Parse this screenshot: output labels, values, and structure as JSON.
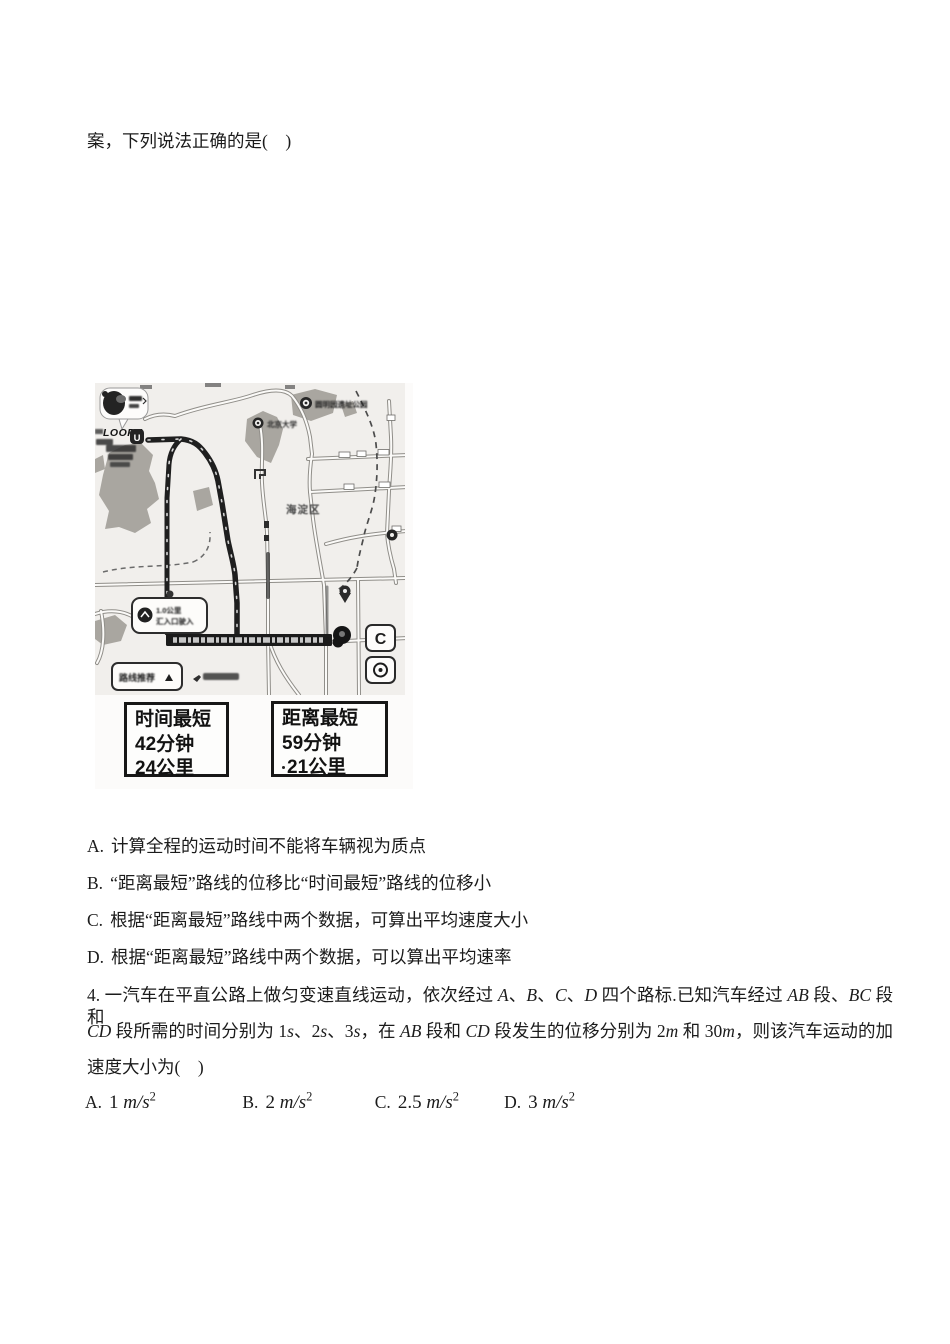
{
  "doc": {
    "intro_line": "案，下列说法正确的是(　)",
    "q3_options": [
      {
        "label": "A.",
        "text": "计算全程的运动时间不能将车辆视为质点"
      },
      {
        "label": "B.",
        "text": "“距离最短”路线的位移比“时间最短”路线的位移小"
      },
      {
        "label": "C.",
        "text": "根据“距离最短”路线中两个数据，可算出平均速度大小"
      },
      {
        "label": "D.",
        "text": "根据“距离最短”路线中两个数据，可以算出平均速率"
      }
    ],
    "q4": {
      "line1": [
        {
          "t": "4. 一汽车在平直公路上做匀变速直线运动，依次经过 "
        },
        {
          "t": "A",
          "i": true
        },
        {
          "t": "、"
        },
        {
          "t": "B",
          "i": true
        },
        {
          "t": "、"
        },
        {
          "t": "C",
          "i": true
        },
        {
          "t": "、"
        },
        {
          "t": "D",
          "i": true
        },
        {
          "t": " 四个路标.已知汽车经过 "
        },
        {
          "t": "AB",
          "i": true
        },
        {
          "t": " 段、"
        },
        {
          "t": "BC",
          "i": true
        },
        {
          "t": " 段和"
        }
      ],
      "line2": [
        {
          "t": "CD",
          "i": true
        },
        {
          "t": " 段所需的时间分别为 1"
        },
        {
          "t": "s",
          "i": true
        },
        {
          "t": "、2"
        },
        {
          "t": "s",
          "i": true
        },
        {
          "t": "、3"
        },
        {
          "t": "s",
          "i": true
        },
        {
          "t": "，在 "
        },
        {
          "t": "AB",
          "i": true
        },
        {
          "t": " 段和 "
        },
        {
          "t": "CD",
          "i": true
        },
        {
          "t": " 段发生的位移分别为 2"
        },
        {
          "t": "m",
          "i": true
        },
        {
          "t": " 和 30"
        },
        {
          "t": "m",
          "i": true
        },
        {
          "t": "，则该汽车运动的加"
        }
      ],
      "line3": [
        {
          "t": "速度大小为(　)"
        }
      ],
      "options": [
        {
          "label": "A.",
          "formula": [
            {
              "t": "1 "
            },
            {
              "t": "m/s",
              "i": true
            },
            {
              "t": "2",
              "sup": true
            }
          ]
        },
        {
          "label": "B.",
          "formula": [
            {
              "t": "2 "
            },
            {
              "t": "m/s",
              "i": true
            },
            {
              "t": "2",
              "sup": true
            }
          ]
        },
        {
          "label": "C.",
          "formula": [
            {
              "t": "2.5 "
            },
            {
              "t": "m/s",
              "i": true
            },
            {
              "t": "2",
              "sup": true
            }
          ]
        },
        {
          "label": "D.",
          "formula": [
            {
              "t": "3 "
            },
            {
              "t": "m/s",
              "i": true
            },
            {
              "t": "2",
              "sup": true
            }
          ]
        }
      ]
    }
  },
  "map_figure": {
    "brand_label": "LOOPY",
    "start_marker": "U",
    "district_label": "海淀区",
    "poi_label_1": "圆明园遗址公园",
    "poi_label_2": "北京大学",
    "nav_bubble_line1": "1.0公里",
    "nav_bubble_line2": "汇入口驶入",
    "route_option_label": "路线推荐",
    "refresh_button_label": "C",
    "route_cards": [
      {
        "title": "时间最短",
        "time": "42分钟",
        "distance": "24公里"
      },
      {
        "title": "距离最短",
        "time": "59分钟",
        "distance": "21公里"
      }
    ]
  }
}
